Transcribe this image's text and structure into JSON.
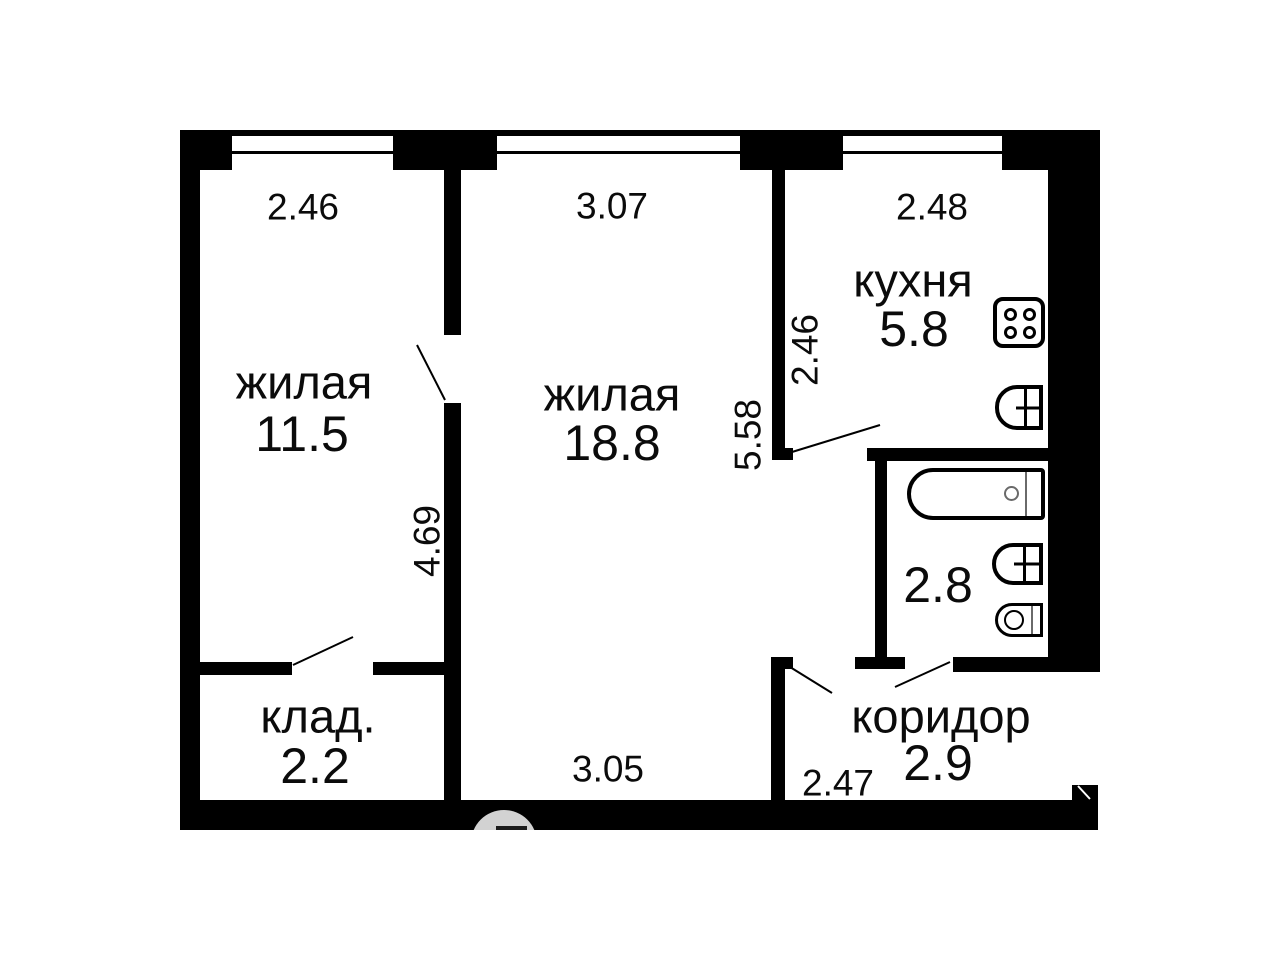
{
  "floorplan": {
    "title": "2-room apartment floor plan",
    "colors": {
      "wall": "#000000",
      "background": "#ffffff",
      "text": "#0b0b0b",
      "watermark": "#d2d2d2"
    },
    "rooms": {
      "living1": {
        "name": "жилая",
        "area": "11.5"
      },
      "living2": {
        "name": "жилая",
        "area": "18.8"
      },
      "kitchen": {
        "name": "кухня",
        "area": "5.8"
      },
      "storage": {
        "name": "клад.",
        "area": "2.2"
      },
      "corridor": {
        "name": "коридор",
        "area": "2.9"
      },
      "bathroom": {
        "area": "2.8"
      }
    },
    "dimensions": {
      "living1_width_top": "2.46",
      "living2_width_top": "3.07",
      "kitchen_width_top": "2.48",
      "kitchen_depth_left": "2.46",
      "living2_height_right": "5.58",
      "living1_height_right": "4.69",
      "living2_width_bottom": "3.05",
      "corridor_width_bottom": "2.47"
    },
    "fixtures": [
      "stove",
      "kitchen-sink",
      "bathtub",
      "bathroom-sink",
      "toilet"
    ],
    "features": [
      "3 windows",
      "5 door swings",
      "entrance at bottom-right"
    ]
  }
}
